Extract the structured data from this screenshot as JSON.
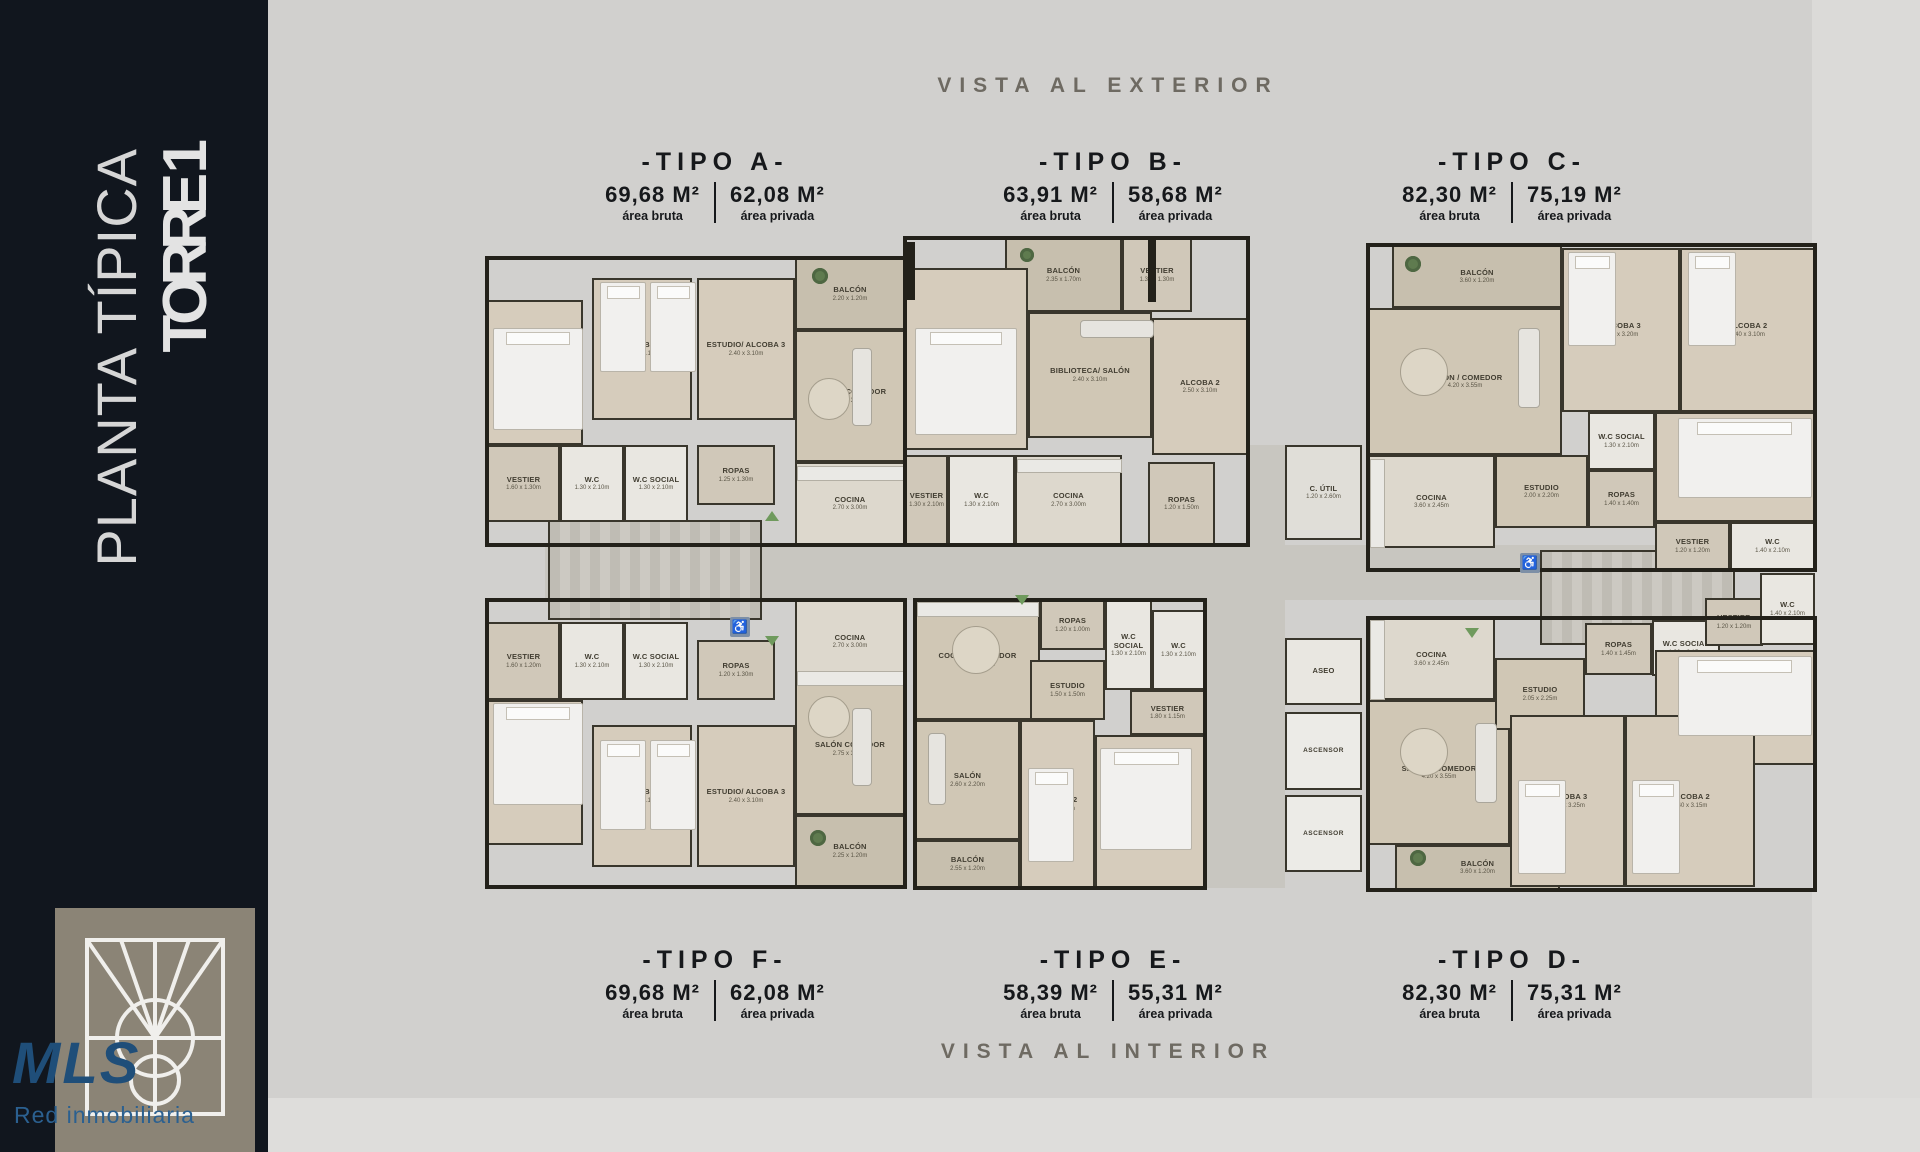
{
  "sidebar": {
    "line1": "PLANTA TÍPICA",
    "line2": "TORRE 1",
    "logo_text": "MLS",
    "logo_sub": "Red inmobiliaria"
  },
  "banners": {
    "top": "VISTA AL EXTERIOR",
    "bottom": "VISTA AL INTERIOR"
  },
  "unit_types": {
    "top": [
      {
        "name": "-TIPO A-",
        "gross_value": "69,68 M²",
        "gross_label": "área bruta",
        "private_value": "62,08 M²",
        "private_label": "área privada"
      },
      {
        "name": "-TIPO B-",
        "gross_value": "63,91 M²",
        "gross_label": "área bruta",
        "private_value": "58,68 M²",
        "private_label": "área privada"
      },
      {
        "name": "-TIPO C-",
        "gross_value": "82,30 M²",
        "gross_label": "área bruta",
        "private_value": "75,19 M²",
        "private_label": "área privada"
      }
    ],
    "bottom": [
      {
        "name": "-TIPO F-",
        "gross_value": "69,68 M²",
        "gross_label": "área bruta",
        "private_value": "62,08 M²",
        "private_label": "área privada"
      },
      {
        "name": "-TIPO E-",
        "gross_value": "58,39 M²",
        "gross_label": "área bruta",
        "private_value": "55,31 M²",
        "private_label": "área privada"
      },
      {
        "name": "-TIPO D-",
        "gross_value": "82,30 M²",
        "gross_label": "área bruta",
        "private_value": "75,31 M²",
        "private_label": "área privada"
      }
    ]
  },
  "colors": {
    "background": "#d1d0ce",
    "sidebar": "#11161e",
    "walls": "#23211a",
    "brand_blue": "#1f4e79",
    "vista_text": "#6e6a62"
  },
  "plan": {
    "accessible_glyph": "♿",
    "rooms": [
      {
        "unit": "A",
        "name": "BALCÓN",
        "dims": "2.20 x 1.20m",
        "kind": "balcony",
        "x": 335,
        "y": 30,
        "w": 110,
        "h": 72
      },
      {
        "unit": "A",
        "name": "ALCOBA PPAL",
        "dims": "2.80 x 3.35m",
        "kind": "bedroom",
        "x": 27,
        "y": 72,
        "w": 96,
        "h": 145
      },
      {
        "unit": "A",
        "name": "VESTIER",
        "dims": "1.60 x 1.30m",
        "kind": "service",
        "x": 27,
        "y": 217,
        "w": 73,
        "h": 77
      },
      {
        "unit": "A",
        "name": "W.C",
        "dims": "1.30 x 2.10m",
        "kind": "bath",
        "x": 100,
        "y": 217,
        "w": 64,
        "h": 77
      },
      {
        "unit": "A",
        "name": "W.C SOCIAL",
        "dims": "1.30 x 2.10m",
        "kind": "bath",
        "x": 164,
        "y": 217,
        "w": 64,
        "h": 77
      },
      {
        "unit": "A",
        "name": "ALCOBA 2",
        "dims": "2.50 x 3.10m",
        "kind": "bedroom",
        "x": 132,
        "y": 50,
        "w": 100,
        "h": 142
      },
      {
        "unit": "A",
        "name": "ESTUDIO/ ALCOBA 3",
        "dims": "2.40 x 3.10m",
        "kind": "bedroom",
        "x": 237,
        "y": 50,
        "w": 98,
        "h": 142
      },
      {
        "unit": "A",
        "name": "ROPAS",
        "dims": "1.25 x 1.30m",
        "kind": "service",
        "x": 237,
        "y": 217,
        "w": 78,
        "h": 60
      },
      {
        "unit": "A",
        "name": "SALÓN/ COMEDOR",
        "dims": "2.75 x 3.00m",
        "kind": "living",
        "x": 335,
        "y": 102,
        "w": 110,
        "h": 132
      },
      {
        "unit": "A",
        "name": "COCINA",
        "dims": "2.70 x 3.00m",
        "kind": "kitchen",
        "x": 335,
        "y": 234,
        "w": 110,
        "h": 83
      },
      {
        "unit": "B",
        "name": "BALCÓN",
        "dims": "2.35 x 1.70m",
        "kind": "balcony",
        "x": 545,
        "y": 10,
        "w": 117,
        "h": 74
      },
      {
        "unit": "B",
        "name": "VESTIER",
        "dims": "1.35 x 1.30m",
        "kind": "service",
        "x": 662,
        "y": 10,
        "w": 70,
        "h": 74
      },
      {
        "unit": "B",
        "name": "ALCOBA 1",
        "dims": "3.00 x 3.20m",
        "kind": "bedroom",
        "x": 445,
        "y": 40,
        "w": 123,
        "h": 182
      },
      {
        "unit": "B",
        "name": "BIBLIOTECA/ SALÓN",
        "dims": "2.40 x 3.10m",
        "kind": "living",
        "x": 568,
        "y": 84,
        "w": 124,
        "h": 126
      },
      {
        "unit": "B",
        "name": "ALCOBA 2",
        "dims": "2.50 x 3.10m",
        "kind": "bedroom",
        "x": 692,
        "y": 90,
        "w": 96,
        "h": 137
      },
      {
        "unit": "B",
        "name": "VESTIER",
        "dims": "1.30 x 2.10m",
        "kind": "service",
        "x": 445,
        "y": 227,
        "w": 43,
        "h": 90
      },
      {
        "unit": "B",
        "name": "W.C",
        "dims": "1.30 x 2.10m",
        "kind": "bath",
        "x": 488,
        "y": 227,
        "w": 67,
        "h": 90
      },
      {
        "unit": "B",
        "name": "COCINA",
        "dims": "2.70 x 3.00m",
        "kind": "kitchen",
        "x": 555,
        "y": 227,
        "w": 107,
        "h": 90
      },
      {
        "unit": "B",
        "name": "ROPAS",
        "dims": "1.20 x 1.50m",
        "kind": "service",
        "x": 688,
        "y": 234,
        "w": 67,
        "h": 83
      },
      {
        "unit": "COMÚN",
        "name": "C. ÚTIL",
        "dims": "1.20 x 2.60m",
        "kind": "utility",
        "x": 825,
        "y": 217,
        "w": 77,
        "h": 95
      },
      {
        "unit": "COMÚN",
        "name": "ASEO",
        "dims": "",
        "kind": "bath",
        "x": 825,
        "y": 410,
        "w": 77,
        "h": 67
      },
      {
        "unit": "COMÚN",
        "name": "ASCENSOR",
        "dims": "",
        "kind": "elevator",
        "x": 825,
        "y": 484,
        "w": 77,
        "h": 78
      },
      {
        "unit": "COMÚN",
        "name": "ASCENSOR",
        "dims": "",
        "kind": "elevator",
        "x": 825,
        "y": 567,
        "w": 77,
        "h": 77
      },
      {
        "unit": "C",
        "name": "BALCÓN",
        "dims": "3.60 x 1.20m",
        "kind": "balcony",
        "x": 932,
        "y": 17,
        "w": 170,
        "h": 63
      },
      {
        "unit": "C",
        "name": "SALÓN / COMEDOR",
        "dims": "4.20 x 3.55m",
        "kind": "living",
        "x": 908,
        "y": 80,
        "w": 194,
        "h": 147
      },
      {
        "unit": "C",
        "name": "COCINA",
        "dims": "3.60 x 2.45m",
        "kind": "kitchen",
        "x": 908,
        "y": 227,
        "w": 127,
        "h": 93
      },
      {
        "unit": "C",
        "name": "ESTUDIO",
        "dims": "2.00 x 2.20m",
        "kind": "living",
        "x": 1035,
        "y": 227,
        "w": 93,
        "h": 73
      },
      {
        "unit": "C",
        "name": "ALCOBA 3",
        "dims": "2.40 x 3.20m",
        "kind": "bedroom",
        "x": 1102,
        "y": 20,
        "w": 118,
        "h": 164
      },
      {
        "unit": "C",
        "name": "ALCOBA 2",
        "dims": "2.40 x 3.10m",
        "kind": "bedroom",
        "x": 1220,
        "y": 20,
        "w": 135,
        "h": 164
      },
      {
        "unit": "C",
        "name": "ALCOBA PPAL",
        "dims": "2.90 x 3.00m",
        "kind": "bedroom",
        "x": 1195,
        "y": 184,
        "w": 160,
        "h": 110
      },
      {
        "unit": "C",
        "name": "ROPAS",
        "dims": "1.40 x 1.40m",
        "kind": "service",
        "x": 1128,
        "y": 242,
        "w": 67,
        "h": 58
      },
      {
        "unit": "C",
        "name": "W.C SOCIAL",
        "dims": "1.30 x 2.10m",
        "kind": "bath",
        "x": 1128,
        "y": 184,
        "w": 67,
        "h": 58
      },
      {
        "unit": "C",
        "name": "VESTIER",
        "dims": "1.20 x 1.20m",
        "kind": "service",
        "x": 1195,
        "y": 294,
        "w": 75,
        "h": 48
      },
      {
        "unit": "C",
        "name": "W.C",
        "dims": "1.40 x 2.10m",
        "kind": "bath",
        "x": 1270,
        "y": 294,
        "w": 85,
        "h": 48
      },
      {
        "unit": "F",
        "name": "W.C",
        "dims": "1.30 x 2.10m",
        "kind": "bath",
        "x": 100,
        "y": 394,
        "w": 64,
        "h": 78
      },
      {
        "unit": "F",
        "name": "W.C SOCIAL",
        "dims": "1.30 x 2.10m",
        "kind": "bath",
        "x": 164,
        "y": 394,
        "w": 64,
        "h": 78
      },
      {
        "unit": "F",
        "name": "VESTIER",
        "dims": "1.60 x 1.20m",
        "kind": "service",
        "x": 27,
        "y": 394,
        "w": 73,
        "h": 78
      },
      {
        "unit": "F",
        "name": "ALCOBA PPAL",
        "dims": "2.80 x 3.35m",
        "kind": "bedroom",
        "x": 27,
        "y": 472,
        "w": 96,
        "h": 145
      },
      {
        "unit": "F",
        "name": "ROPAS",
        "dims": "1.20 x 1.30m",
        "kind": "service",
        "x": 237,
        "y": 412,
        "w": 78,
        "h": 60
      },
      {
        "unit": "F",
        "name": "ALCOBA 2",
        "dims": "2.50 x 3.10m",
        "kind": "bedroom",
        "x": 132,
        "y": 497,
        "w": 100,
        "h": 142
      },
      {
        "unit": "F",
        "name": "ESTUDIO/ ALCOBA 3",
        "dims": "2.40 x 3.10m",
        "kind": "bedroom",
        "x": 237,
        "y": 497,
        "w": 98,
        "h": 142
      },
      {
        "unit": "F",
        "name": "COCINA",
        "dims": "2.70 x 3.00m",
        "kind": "kitchen",
        "x": 335,
        "y": 372,
        "w": 110,
        "h": 83
      },
      {
        "unit": "F",
        "name": "SALÓN COMEDOR",
        "dims": "2.75 x 3.00m",
        "kind": "living",
        "x": 335,
        "y": 455,
        "w": 110,
        "h": 132
      },
      {
        "unit": "F",
        "name": "BALCÓN",
        "dims": "2.25 x 1.20m",
        "kind": "balcony",
        "x": 335,
        "y": 587,
        "w": 110,
        "h": 72
      },
      {
        "unit": "E",
        "name": "COCINA / COMEDOR",
        "dims": "2.90 x 3.60m",
        "kind": "living",
        "x": 455,
        "y": 372,
        "w": 125,
        "h": 120
      },
      {
        "unit": "E",
        "name": "SALÓN",
        "dims": "2.60 x 2.20m",
        "kind": "living",
        "x": 455,
        "y": 492,
        "w": 105,
        "h": 120
      },
      {
        "unit": "E",
        "name": "BALCÓN",
        "dims": "2.55 x 1.20m",
        "kind": "balcony",
        "x": 455,
        "y": 612,
        "w": 105,
        "h": 48
      },
      {
        "unit": "E",
        "name": "ROPAS",
        "dims": "1.20 x 1.00m",
        "kind": "service",
        "x": 580,
        "y": 372,
        "w": 65,
        "h": 50
      },
      {
        "unit": "E",
        "name": "ESTUDIO",
        "dims": "1.50 x 1.50m",
        "kind": "living",
        "x": 570,
        "y": 432,
        "w": 75,
        "h": 60
      },
      {
        "unit": "E",
        "name": "W.C SOCIAL",
        "dims": "1.30 x 2.10m",
        "kind": "bath",
        "x": 645,
        "y": 372,
        "w": 47,
        "h": 90
      },
      {
        "unit": "E",
        "name": "W.C",
        "dims": "1.30 x 2.10m",
        "kind": "bath",
        "x": 692,
        "y": 382,
        "w": 53,
        "h": 80
      },
      {
        "unit": "E",
        "name": "VESTIER",
        "dims": "1.80 x 1.15m",
        "kind": "service",
        "x": 670,
        "y": 462,
        "w": 75,
        "h": 45
      },
      {
        "unit": "E",
        "name": "ALCOBA PPAL",
        "dims": "2.80 x 3.05m",
        "kind": "bedroom",
        "x": 635,
        "y": 507,
        "w": 110,
        "h": 153
      },
      {
        "unit": "E",
        "name": "ALCOBA 2",
        "dims": "2.40 x 2.70m",
        "kind": "bedroom",
        "x": 560,
        "y": 492,
        "w": 75,
        "h": 168
      },
      {
        "unit": "D",
        "name": "COCINA",
        "dims": "3.60 x 2.45m",
        "kind": "kitchen",
        "x": 908,
        "y": 390,
        "w": 127,
        "h": 82
      },
      {
        "unit": "D",
        "name": "SALÓN / COMEDOR",
        "dims": "4.20 x 3.55m",
        "kind": "living",
        "x": 908,
        "y": 472,
        "w": 142,
        "h": 145
      },
      {
        "unit": "D",
        "name": "BALCÓN",
        "dims": "3.60 x 1.20m",
        "kind": "balcony",
        "x": 935,
        "y": 617,
        "w": 165,
        "h": 45
      },
      {
        "unit": "D",
        "name": "ESTUDIO",
        "dims": "2.05 x 2.25m",
        "kind": "living",
        "x": 1035,
        "y": 430,
        "w": 90,
        "h": 72
      },
      {
        "unit": "D",
        "name": "ROPAS",
        "dims": "1.40 x 1.45m",
        "kind": "service",
        "x": 1125,
        "y": 395,
        "w": 67,
        "h": 52
      },
      {
        "unit": "D",
        "name": "W.C SOCIAL",
        "dims": "1.30 x 2.15m",
        "kind": "bath",
        "x": 1192,
        "y": 392,
        "w": 68,
        "h": 56
      },
      {
        "unit": "D",
        "name": "VESTIER",
        "dims": "1.20 x 1.20m",
        "kind": "service",
        "x": 1245,
        "y": 370,
        "w": 58,
        "h": 48
      },
      {
        "unit": "D",
        "name": "W.C",
        "dims": "1.40 x 2.10m",
        "kind": "bath",
        "x": 1300,
        "y": 345,
        "w": 55,
        "h": 72
      },
      {
        "unit": "D",
        "name": "ALCOBA PPAL",
        "dims": "2.90 x 3.00m",
        "kind": "bedroom",
        "x": 1195,
        "y": 422,
        "w": 160,
        "h": 115
      },
      {
        "unit": "D",
        "name": "ALCOBA 3",
        "dims": "2.40 x 3.25m",
        "kind": "bedroom",
        "x": 1050,
        "y": 487,
        "w": 115,
        "h": 172
      },
      {
        "unit": "D",
        "name": "ALCOBA 2",
        "dims": "2.40 x 3.15m",
        "kind": "bedroom",
        "x": 1165,
        "y": 487,
        "w": 130,
        "h": 172
      }
    ]
  }
}
